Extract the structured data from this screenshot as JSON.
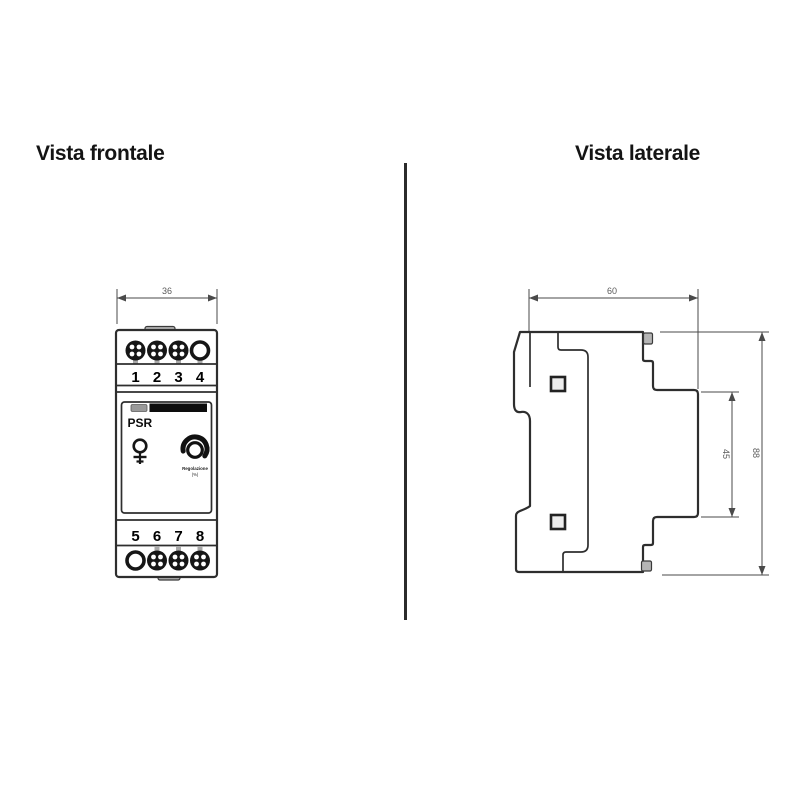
{
  "titles": {
    "front": "Vista frontale",
    "side": "Vista laterale"
  },
  "front_view": {
    "width_dim": "36",
    "terminals_top": [
      "1",
      "2",
      "3",
      "4"
    ],
    "terminals_bottom": [
      "5",
      "6",
      "7",
      "8"
    ],
    "faceplate": {
      "model": "PSR",
      "knob_label": "Regolazione",
      "knob_unit": "(%)"
    }
  },
  "side_view": {
    "depth_dim": "60",
    "front_height_dim": "45",
    "total_height_dim": "88"
  }
}
